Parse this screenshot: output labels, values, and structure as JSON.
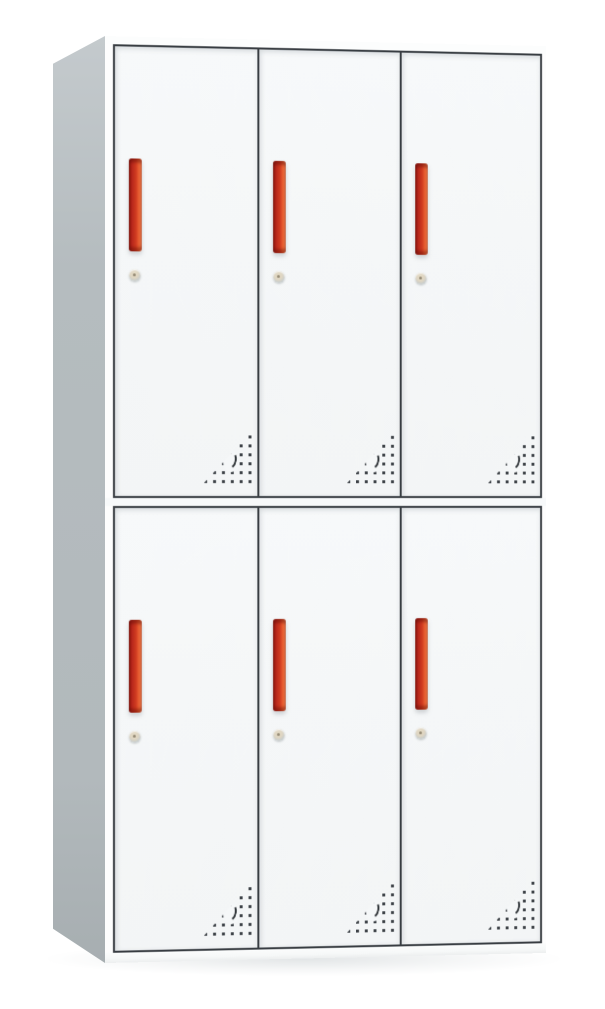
{
  "scene": {
    "subject": "White steel locker cabinet with six doors, photographed in three-quarter view on a white background",
    "rows": 2,
    "columns": 3,
    "door_count": 6,
    "door_features": [
      "vertical red recessed handle",
      "round cam lock keyhole below handle",
      "triangular perforated vent pattern with crescent cutout at lower right corner"
    ]
  },
  "colors": {
    "background": "#ffffff",
    "door_face": "#f5f7f8",
    "frame_line": "#383d42",
    "side_panel_light": "#c4cacd",
    "side_panel": "#b5bcbf",
    "side_panel_dark": "#a7aeb1",
    "gap_strip": "#f7f9fa",
    "plinth": "#fbfcfc",
    "handle_dark": "#8f1a10",
    "handle_red": "#d03b20",
    "handle_orange": "#f58d5e",
    "lock_ring": "#c6cccd",
    "lock_center": "#e7ddc7",
    "vent_dot": "#3d4247"
  },
  "doors": [
    {
      "id": "door-top-left",
      "row": 1,
      "col": 1
    },
    {
      "id": "door-top-center",
      "row": 1,
      "col": 2
    },
    {
      "id": "door-top-right",
      "row": 1,
      "col": 3
    },
    {
      "id": "door-bottom-left",
      "row": 2,
      "col": 1
    },
    {
      "id": "door-bottom-center",
      "row": 2,
      "col": 2
    },
    {
      "id": "door-bottom-right",
      "row": 2,
      "col": 3
    }
  ]
}
